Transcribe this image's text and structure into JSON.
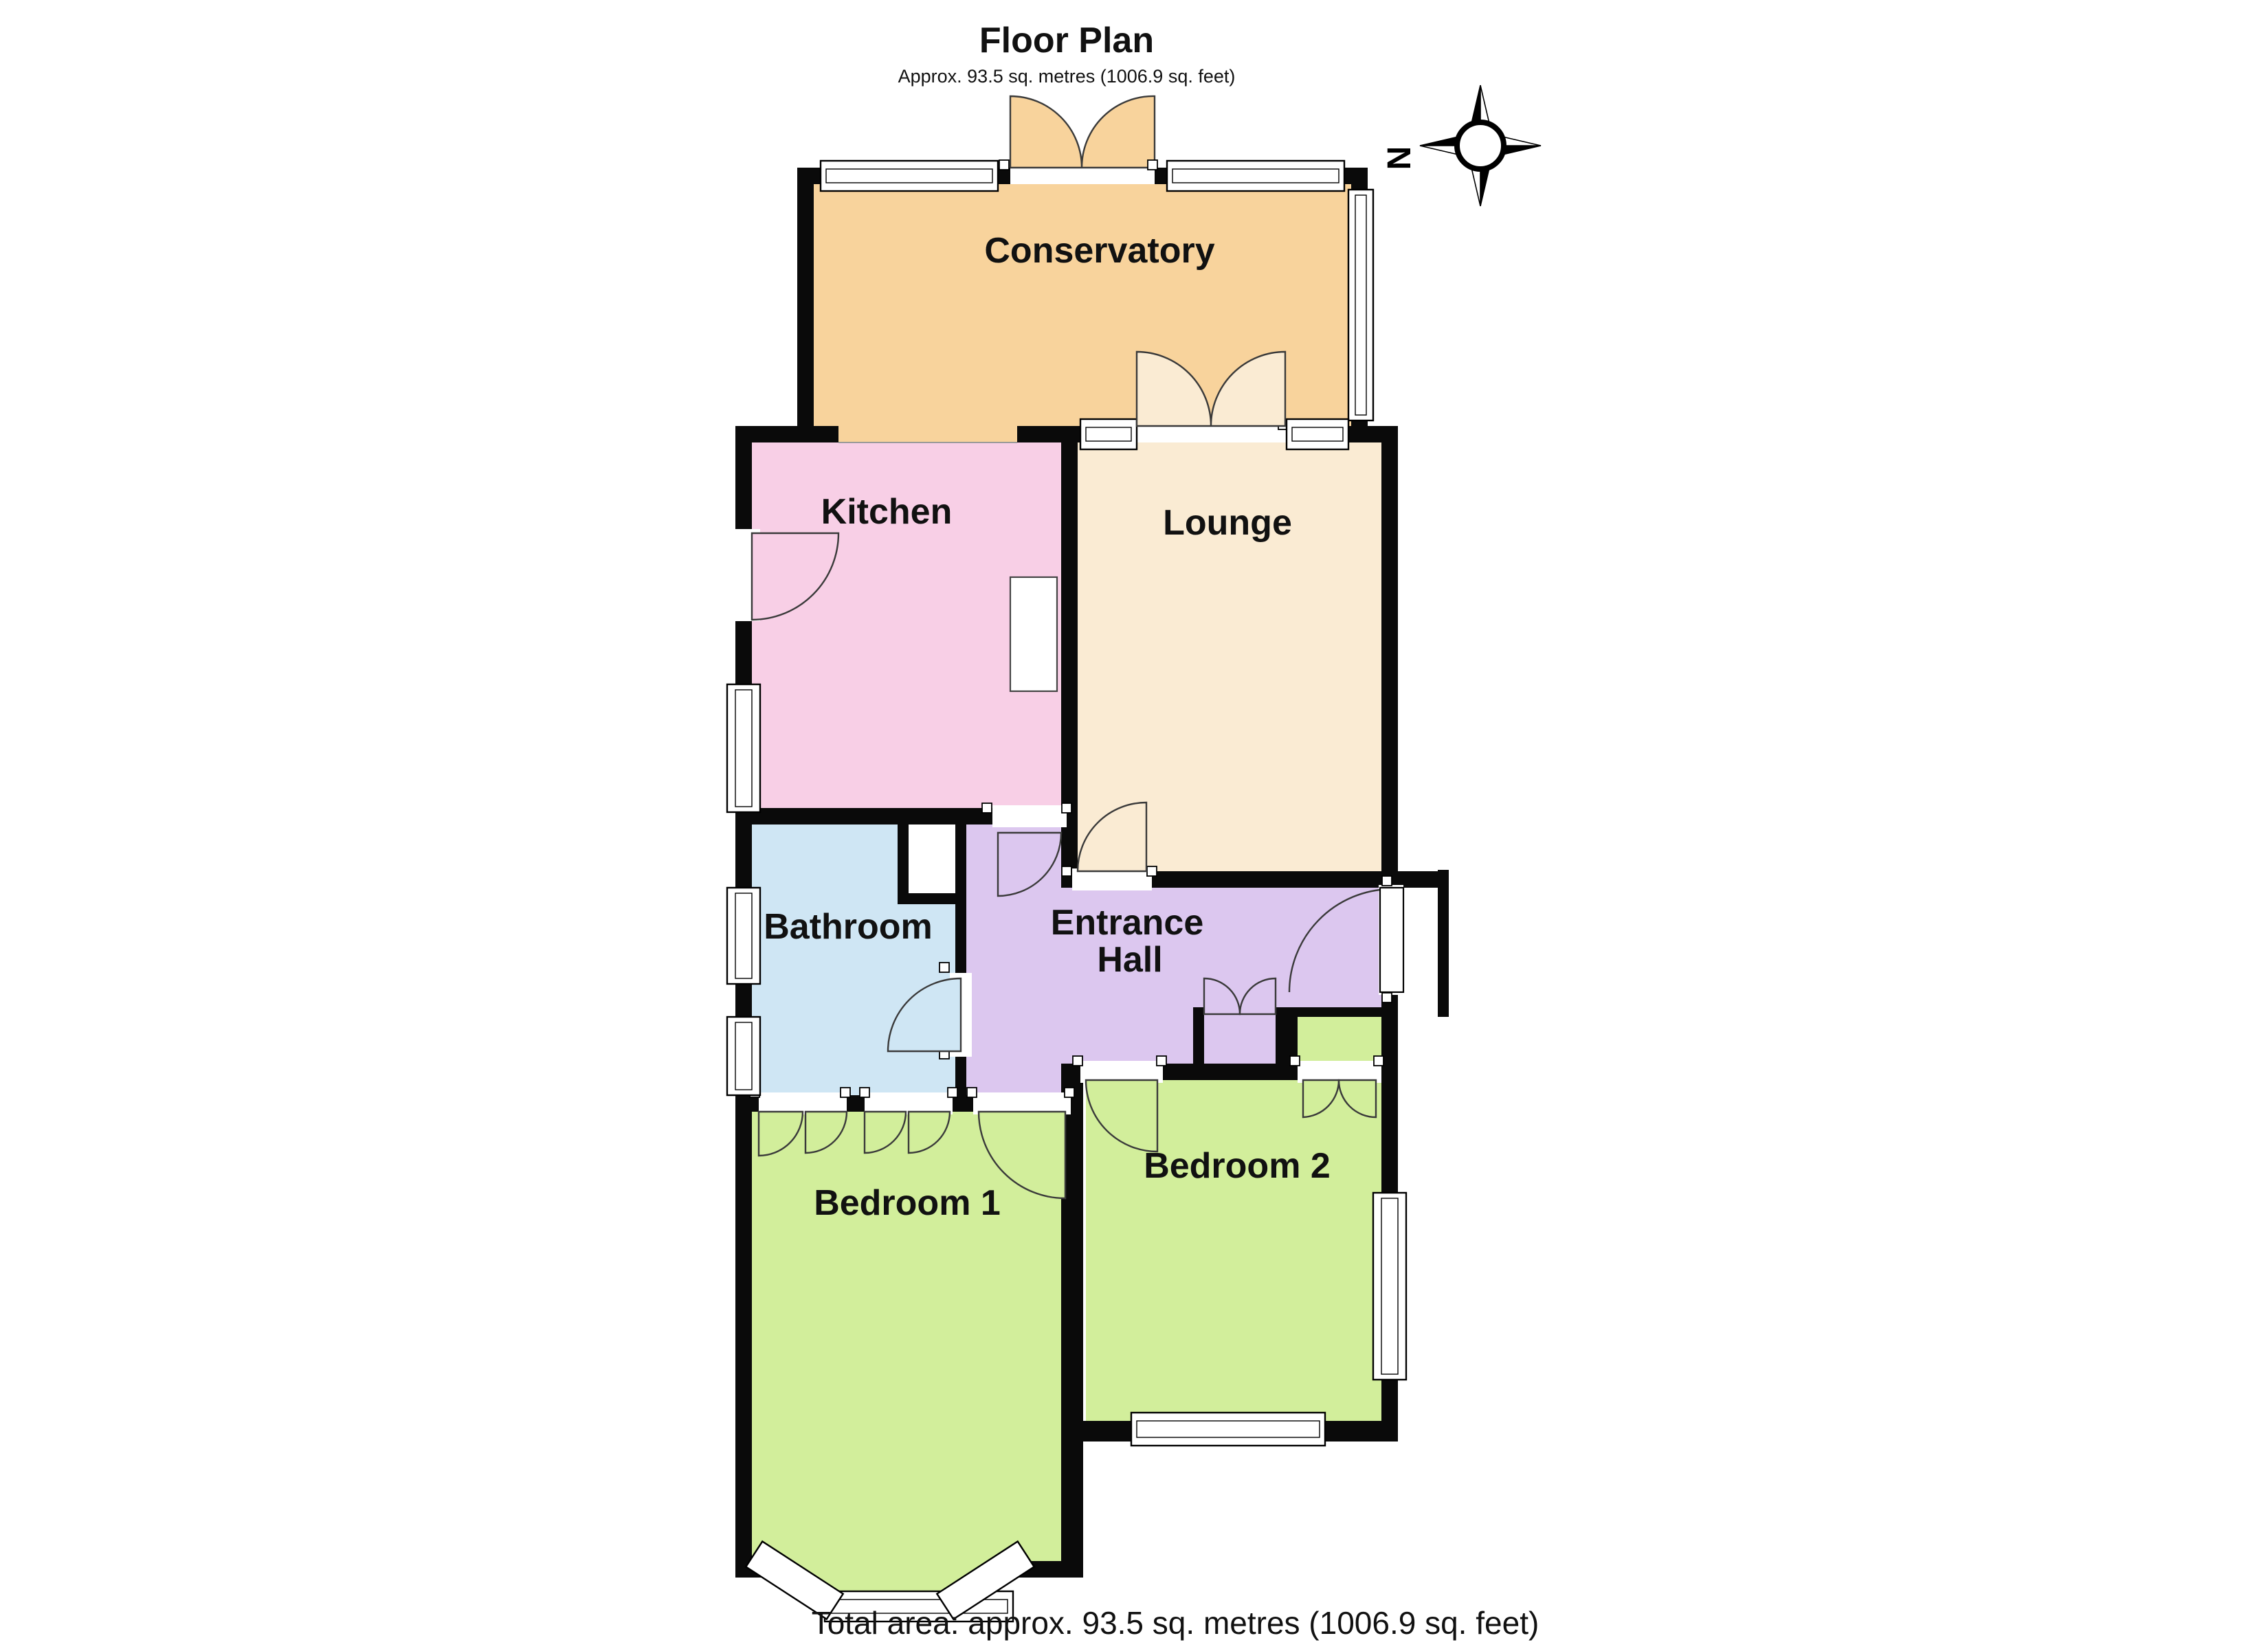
{
  "page": {
    "title": "Floor Plan",
    "subtitle": "Approx. 93.5 sq. metres (1006.9 sq. feet)",
    "footer": "Total area: approx. 93.5 sq. metres (1006.9 sq. feet)"
  },
  "compass": {
    "north_label": "N"
  },
  "rooms": {
    "conservatory": "Conservatory",
    "kitchen": "Kitchen",
    "lounge": "Lounge",
    "bathroom": "Bathroom",
    "entrance_hall_line1": "Entrance",
    "entrance_hall_line2": "Hall",
    "bedroom1": "Bedroom 1",
    "bedroom2": "Bedroom 2"
  },
  "colors": {
    "wall": "#0a0a0a",
    "conservatory": "#F8D39C",
    "lounge": "#FAEBD3",
    "kitchen": "#F8CFE6",
    "bathroom": "#CFE6F4",
    "hall": "#DCC7EF",
    "bedroom": "#D2EE9B",
    "text": "#111111"
  }
}
